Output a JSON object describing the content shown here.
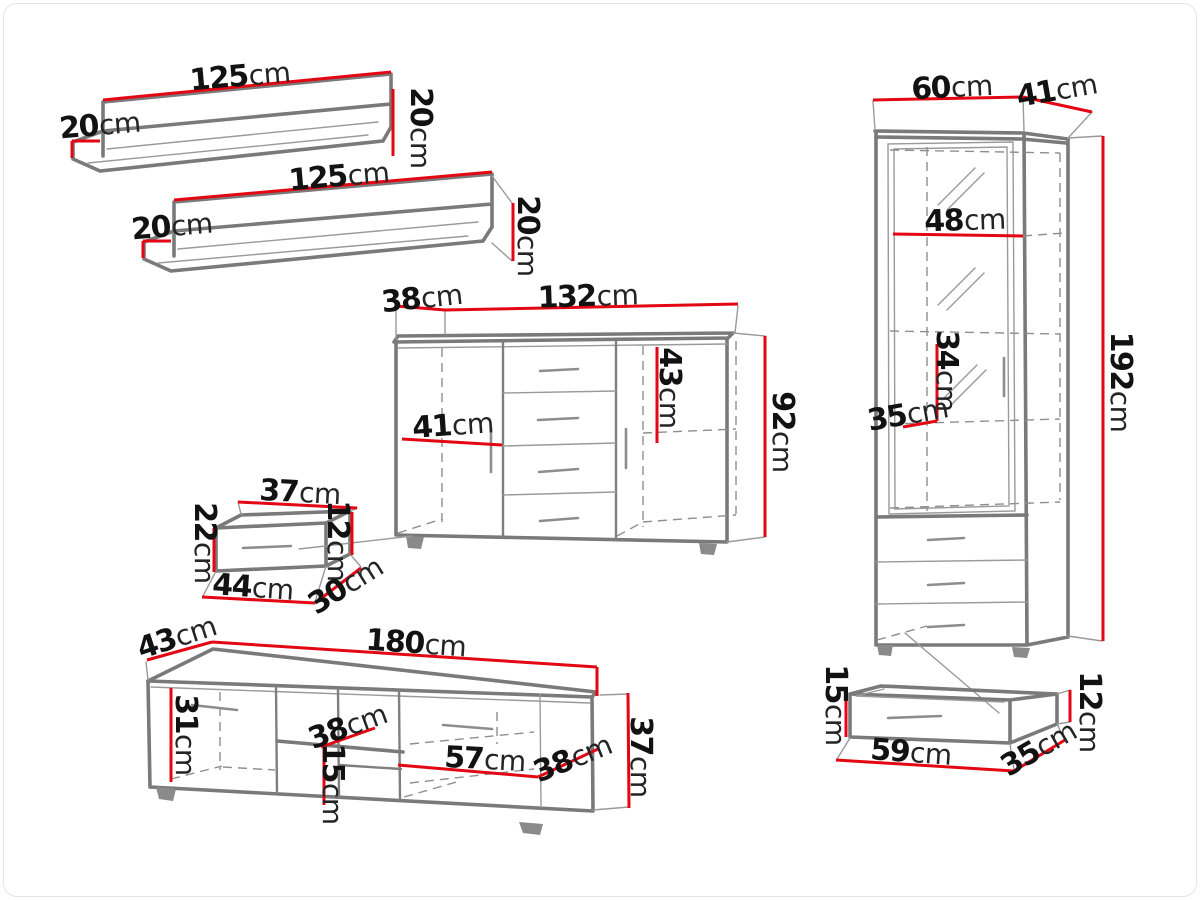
{
  "palette": {
    "dimension_red": "#e30613",
    "furniture_gray": "#7a7a7a",
    "text_black": "#121212",
    "background": "#ffffff"
  },
  "unit": "cm",
  "pieces": {
    "wall_shelf_1": {
      "width": {
        "v": "125",
        "u": "cm"
      },
      "depth": {
        "v": "20",
        "u": "cm"
      },
      "height": {
        "v": "20",
        "u": "cm"
      }
    },
    "wall_shelf_2": {
      "width": {
        "v": "125",
        "u": "cm"
      },
      "depth": {
        "v": "20",
        "u": "cm"
      },
      "height": {
        "v": "20",
        "u": "cm"
      }
    },
    "sideboard": {
      "depth": {
        "v": "38",
        "u": "cm"
      },
      "width": {
        "v": "132",
        "u": "cm"
      },
      "door_width": {
        "v": "41",
        "u": "cm"
      },
      "inner_height": {
        "v": "43",
        "u": "cm"
      },
      "height": {
        "v": "92",
        "u": "cm"
      }
    },
    "hanging_shelf": {
      "top_width": {
        "v": "37",
        "u": "cm"
      },
      "height": {
        "v": "22",
        "u": "cm"
      },
      "side_height": {
        "v": "12",
        "u": "cm"
      },
      "bottom_width": {
        "v": "44",
        "u": "cm"
      },
      "depth": {
        "v": "30",
        "u": "cm"
      }
    },
    "tv_stand": {
      "depth": {
        "v": "43",
        "u": "cm"
      },
      "width": {
        "v": "180",
        "u": "cm"
      },
      "inner_height": {
        "v": "31",
        "u": "cm"
      },
      "shelf_depth": {
        "v": "38",
        "u": "cm"
      },
      "shelf_spacing": {
        "v": "15",
        "u": "cm"
      },
      "inner_width": {
        "v": "57",
        "u": "cm"
      },
      "door_width": {
        "v": "38",
        "u": "cm"
      },
      "height": {
        "v": "37",
        "u": "cm"
      }
    },
    "display_cabinet": {
      "width": {
        "v": "60",
        "u": "cm"
      },
      "depth": {
        "v": "41",
        "u": "cm"
      },
      "shelf_width": {
        "v": "48",
        "u": "cm"
      },
      "inner_height": {
        "v": "34",
        "u": "cm"
      },
      "shelf_depth": {
        "v": "35",
        "u": "cm"
      },
      "height": {
        "v": "192",
        "u": "cm"
      }
    },
    "under_drawer": {
      "height": {
        "v": "15",
        "u": "cm"
      },
      "side_height": {
        "v": "12",
        "u": "cm"
      },
      "width": {
        "v": "59",
        "u": "cm"
      },
      "depth": {
        "v": "35",
        "u": "cm"
      }
    }
  }
}
